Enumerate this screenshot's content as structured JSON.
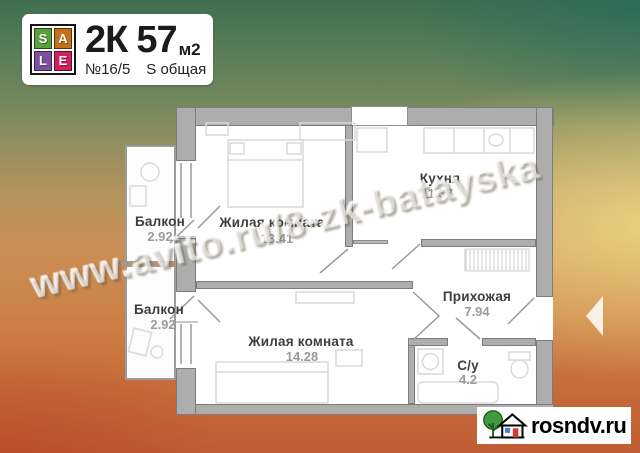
{
  "badge": {
    "logo_letters": [
      "S",
      "A",
      "L",
      "E"
    ],
    "rooms_label": "2К",
    "area_value": "57",
    "area_unit": "м2",
    "flat_number": "№16/5",
    "area_type": "S общая"
  },
  "plan": {
    "rooms": [
      {
        "name": "Балкон",
        "area": "2.92"
      },
      {
        "name": "Жилая комната",
        "area": "13.41"
      },
      {
        "name": "Кухня",
        "area": "11.37"
      },
      {
        "name": "Балкон",
        "area": "2.92"
      },
      {
        "name": "Жилая комната",
        "area": "14.28"
      },
      {
        "name": "Прихожая",
        "area": "7.94"
      },
      {
        "name": "С/у",
        "area": "4.2"
      }
    ]
  },
  "watermark": "www.avito.ru/8-zk-batayska",
  "brand": {
    "site": "rosndv.ru"
  },
  "icons": {
    "sale_logo": "sale-2x2-letter-grid",
    "brand_icon": "house-with-tree",
    "nav_arrow": "left-triangle"
  },
  "colors": {
    "sale_s": "#5ba13b",
    "sale_a": "#c4711c",
    "sale_l": "#7d4fa0",
    "sale_e": "#d0215c",
    "wall": "#adadad",
    "bg_top": "#3f6e4f",
    "bg_mid": "#d8c47e",
    "bg_bottom": "#c05c34",
    "tree": "#3f9b3f",
    "door": "#d23b2f",
    "window": "#4a7dd4"
  }
}
